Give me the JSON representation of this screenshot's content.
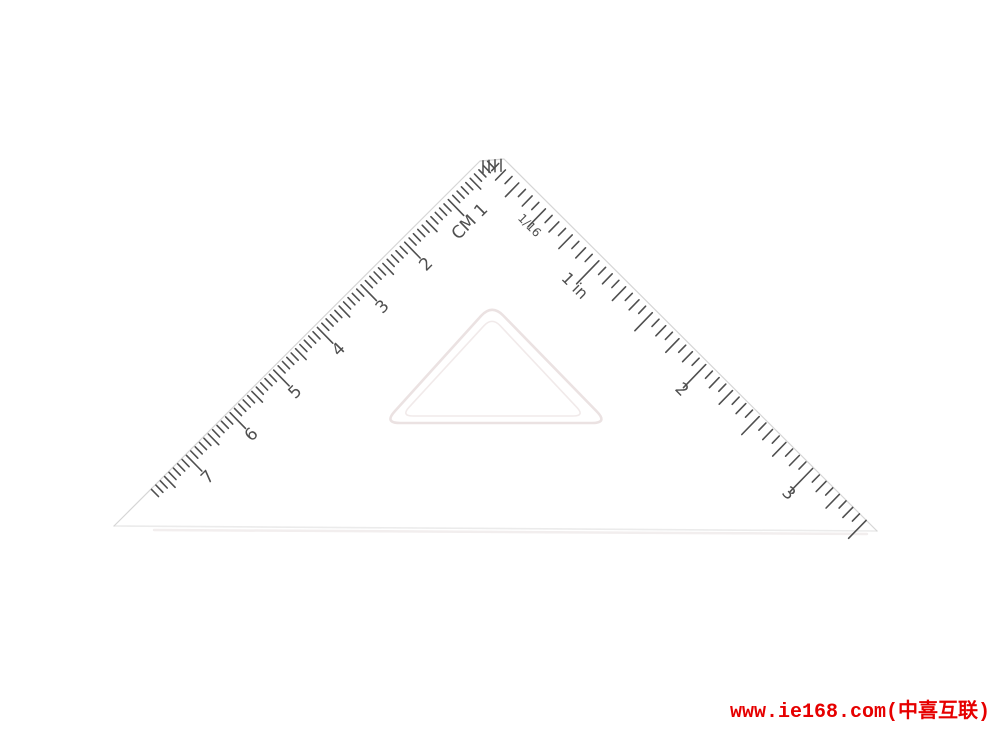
{
  "page": {
    "background": "#ffffff"
  },
  "watermark": {
    "text": "www.ie168.com(中喜互联)",
    "color": "#e60000"
  },
  "ruler": {
    "description": "transparent 45-degree set square with cm and inch scales",
    "tick_color": "#4f4f4f",
    "edge_color": "#d6d6d6",
    "bottom_edge_color": "#ebebeb",
    "shadow_color": "#f2eeee",
    "cutout_color_outer": "#ebe2e2",
    "cutout_color_inner": "#f1eaea",
    "apex": [
      492,
      157
    ],
    "bottom_left": [
      114,
      526
    ],
    "bottom_right": [
      877,
      531
    ],
    "tip_flat": {
      "from": [
        480,
        161
      ],
      "to": [
        504,
        159
      ],
      "tick_count": 4,
      "tick_len": 12
    },
    "cm_scale": {
      "mm_px": 6.1,
      "total_mm": 78,
      "tick_len": {
        "minor": 10,
        "medium": 15,
        "major": 22
      },
      "label_inset": 36,
      "font_size": 17,
      "labels": [
        {
          "at_mm": 10,
          "text": "CM 1"
        },
        {
          "at_mm": 20,
          "text": "2"
        },
        {
          "at_mm": 30,
          "text": "3"
        },
        {
          "at_mm": 40,
          "text": "4"
        },
        {
          "at_mm": 50,
          "text": "5"
        },
        {
          "at_mm": 60,
          "text": "6"
        },
        {
          "at_mm": 70,
          "text": "7"
        }
      ]
    },
    "inch_scale": {
      "sixteenth_px": 9.3125,
      "total_sixteenths": 56,
      "tick_len": {
        "s16": 10,
        "s8": 14,
        "s4": 19,
        "s2": 25,
        "s1": 32
      },
      "label_inset": 40,
      "font_size": 17,
      "labels": [
        {
          "at_16th": 8,
          "text": "1/16",
          "inset": 27,
          "size": 12
        },
        {
          "at_16th": 16,
          "text": "1 in",
          "size": 16
        },
        {
          "at_16th": 32,
          "text": "2"
        },
        {
          "at_16th": 48,
          "text": "3"
        }
      ]
    },
    "cutout": {
      "outer": {
        "apex": [
          492,
          304
        ],
        "left": [
          384,
          423
        ],
        "right": [
          608,
          423
        ],
        "radius": 16,
        "width": 2.6
      },
      "inner": {
        "apex": [
          492,
          317
        ],
        "left": [
          401,
          416
        ],
        "right": [
          585,
          416
        ],
        "radius": 12,
        "width": 1.6
      }
    }
  }
}
